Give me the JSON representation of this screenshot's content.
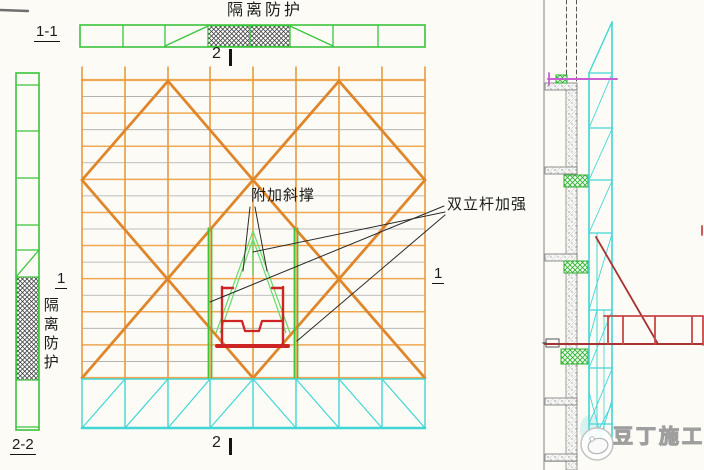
{
  "labels": {
    "top_isolation": "隔离防护",
    "left_isolation": "隔离防护",
    "section_1_1": "1-1",
    "section_2_2": "2-2",
    "section_1_left": "1",
    "section_1_right": "1",
    "section_2_top": "2",
    "section_2_bottom": "2",
    "annotation_diagonal_brace": "附加斜撑",
    "annotation_double_pole": "双立杆加强",
    "watermark": "豆丁施工"
  },
  "icons": {
    "watermark_logo": "docin-bean-logo"
  },
  "colors": {
    "scaffold_green": "#3cc43c",
    "light_green": "#68da68",
    "frame_orange": "#e79b3f",
    "grid_orange": "#efa851",
    "brace_orange": "#e0862a",
    "grid_gray": "#a9a9a9",
    "truss_cyan": "#41d6d6",
    "bracket_red": "#cf2424",
    "platform_red": "#c74848",
    "tie_red": "#a83232",
    "tie_magenta": "#c95fd2",
    "leader_black": "#2a2a2a",
    "wall_gray": "#888888"
  }
}
